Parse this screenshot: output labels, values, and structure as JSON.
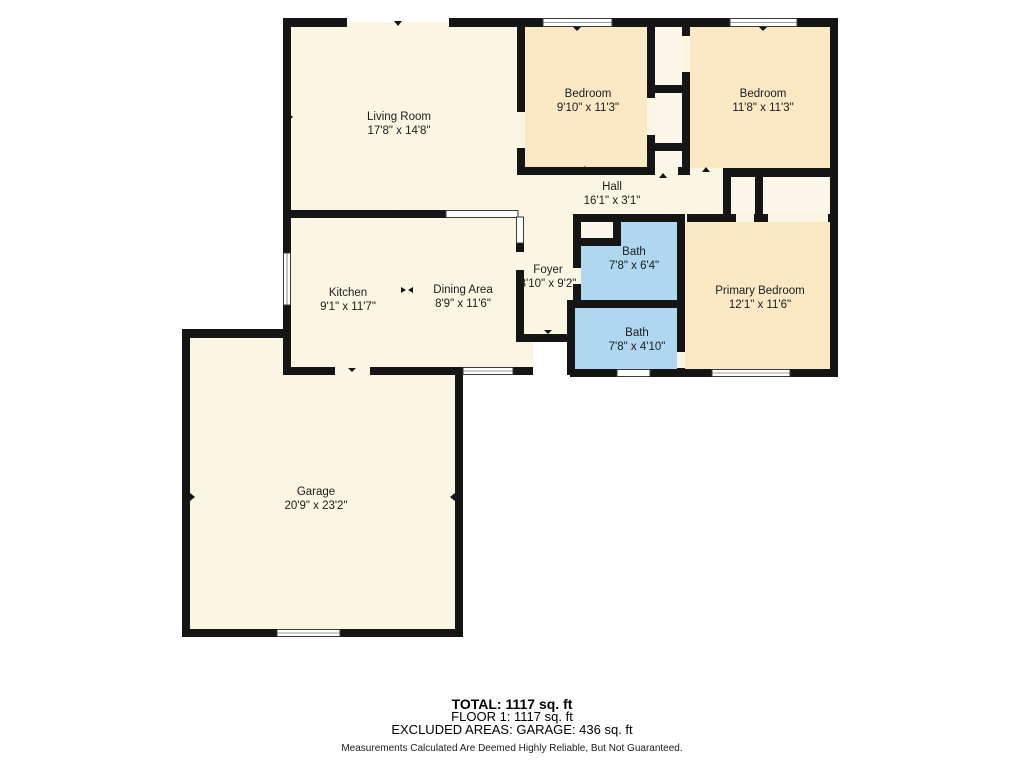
{
  "rooms": [
    {
      "name": "Living Room",
      "dims": "17'8\" x 14'8\""
    },
    {
      "name": "Bedroom",
      "dims": "9'10\" x 11'3\""
    },
    {
      "name": "Bedroom",
      "dims": "11'8\" x 11'3\""
    },
    {
      "name": "Hall",
      "dims": "16'1\" x 3'1\""
    },
    {
      "name": "Kitchen",
      "dims": "9'1\" x 11'7\""
    },
    {
      "name": "Dining Area",
      "dims": "8'9\" x 11'6\""
    },
    {
      "name": "Foyer",
      "dims": "3'10\" x 9'2\""
    },
    {
      "name": "Bath",
      "dims": "7'8\" x 6'4\""
    },
    {
      "name": "Bath",
      "dims": "7'8\" x 4'10\""
    },
    {
      "name": "Primary Bedroom",
      "dims": "12'1\" x 11'6\""
    },
    {
      "name": "Garage",
      "dims": "20'9\" x 23'2\""
    }
  ],
  "summary": {
    "total": "TOTAL: 1117 sq. ft",
    "floor": "FLOOR 1: 1117 sq. ft",
    "excluded": "EXCLUDED AREAS: GARAGE: 436 sq. ft",
    "disclaimer": "Measurements Calculated Are Deemed Highly Reliable, But Not Guaranteed."
  },
  "colors": {
    "room_cream": "#FAF6E3",
    "closet_cream": "#FBF8EB",
    "bedroom_tan": "#FAE9C4",
    "bath_blue": "#AFD7F0",
    "wall_black": "#151515",
    "background": "#FFFFFF"
  }
}
